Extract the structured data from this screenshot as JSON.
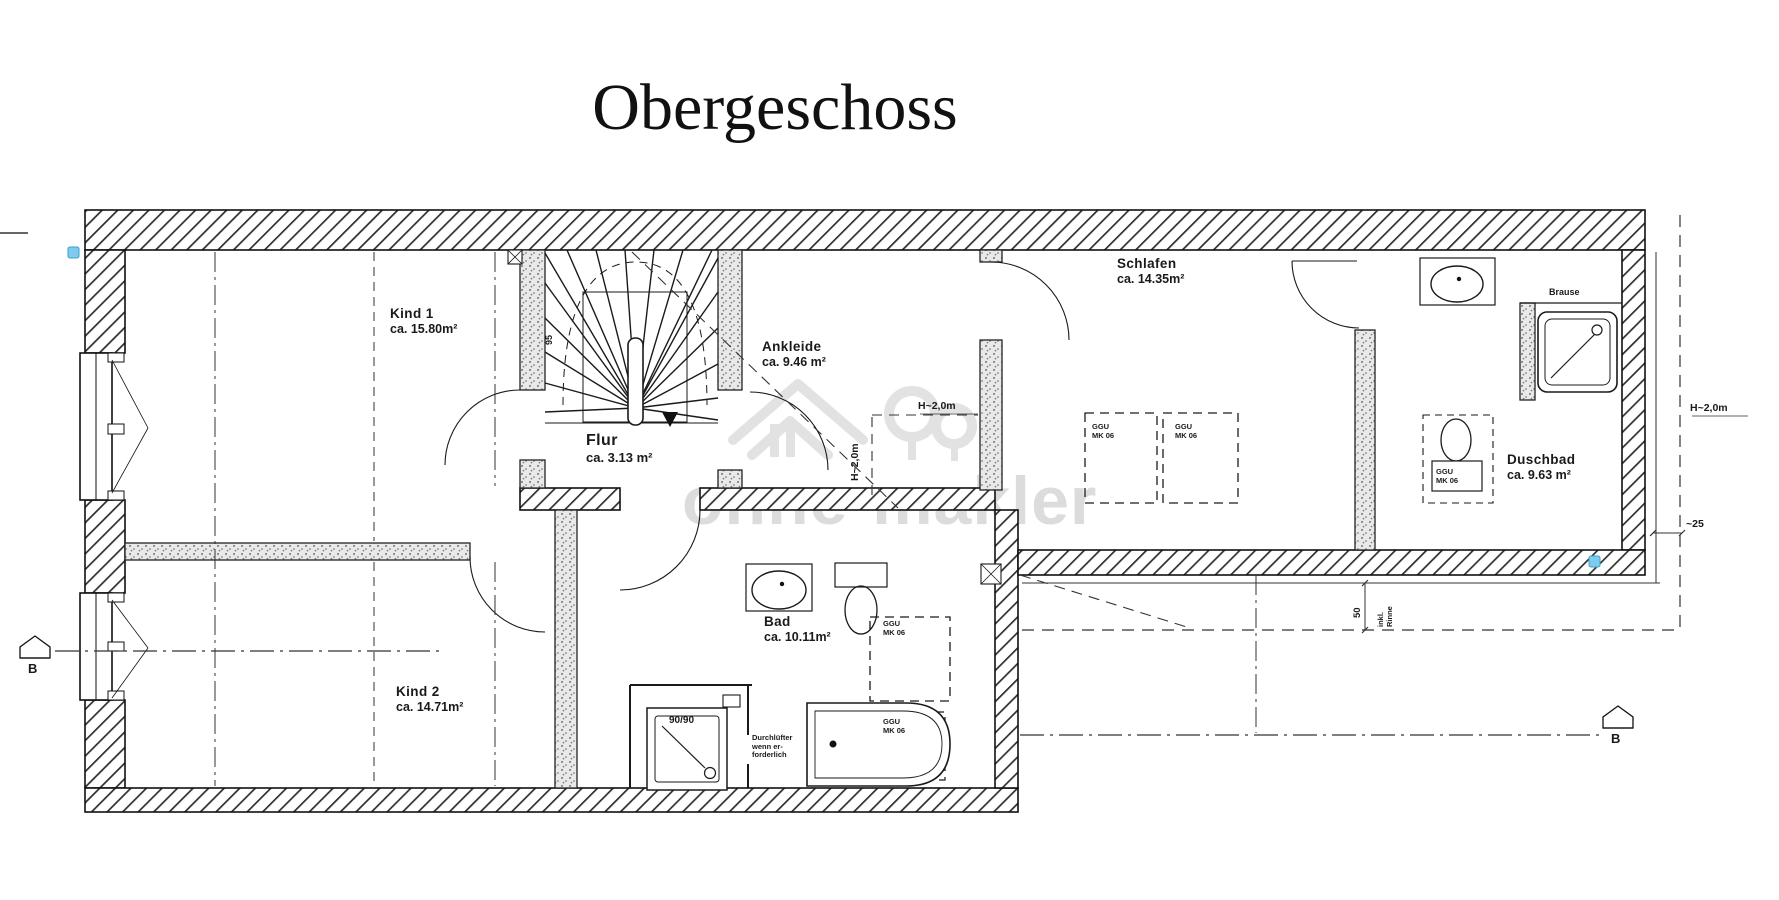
{
  "title": "Obergeschoss",
  "watermark": "ohne-makler",
  "rooms": {
    "kind1": {
      "name": "Kind  1",
      "area": "ca. 15.80m²"
    },
    "ankleide": {
      "name": "Ankleide",
      "area": "ca. 9.46 m²"
    },
    "flur": {
      "name": "Flur",
      "area": "ca. 3.13  m²"
    },
    "schlafen": {
      "name": "Schlafen",
      "area": "ca. 14.35m²"
    },
    "duschbad": {
      "name": "Duschbad",
      "area": "ca. 9.63  m²"
    },
    "bad": {
      "name": "Bad",
      "area": "ca. 10.11m²"
    },
    "kind2": {
      "name": "Kind 2",
      "area": "ca. 14.71m²"
    }
  },
  "fixtures": {
    "shower_label": "Brause",
    "shower_tray_size": "90/90",
    "vent_note_line1": "Durchlüfter",
    "vent_note_line2": "wenn er-",
    "vent_note_line3": "forderlich"
  },
  "roof_windows": {
    "brand_line1": "GGU",
    "brand_line2": "MK 06"
  },
  "dimensions": {
    "height_line_right": "H~2,0m",
    "height_line_mid_h": "H~2,0m",
    "height_line_mid_v": "H~2,0m",
    "eaves_offset": "~25",
    "gutter_width": "50",
    "gutter_note_line1": "inkl.",
    "gutter_note_line2": "Rinne",
    "stair_width": "95"
  },
  "section_markers": {
    "left": "B",
    "right": "B"
  },
  "colors": {
    "ink": "#1a1a1a",
    "watermark": "#dcdcdc",
    "marker_blue": "#7ecbee"
  }
}
